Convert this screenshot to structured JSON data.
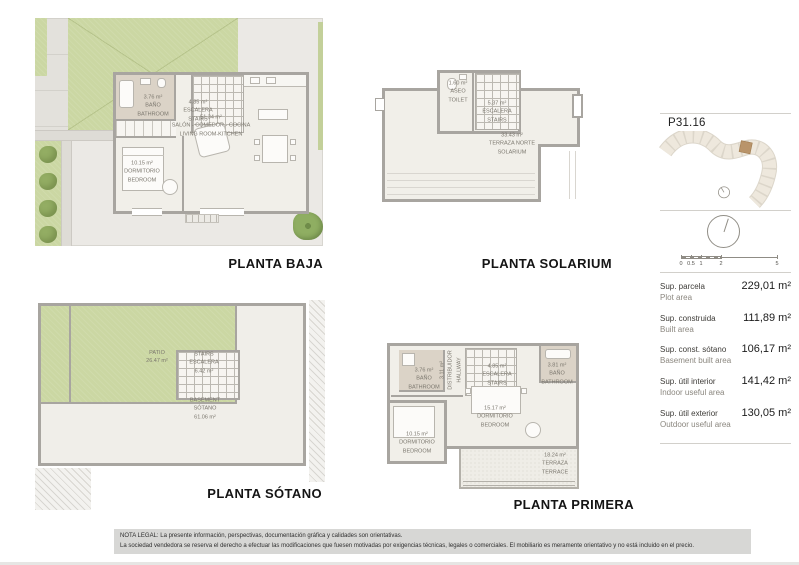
{
  "plans": [
    {
      "title": "PLANTA BAJA",
      "rooms": {
        "bathroom": [
          "3.76 m²",
          "BAÑO",
          "BATHROOM"
        ],
        "stairs": [
          "4.85 m²",
          "ESCALERA",
          "STAIRS"
        ],
        "living": [
          "51.34 m²",
          "SALÓN - COMEDOR - COCINA",
          "LIVING ROOM-KITCHEN"
        ],
        "bedroom": [
          "10.15 m²",
          "DORMITORIO",
          "BEDROOM"
        ]
      }
    },
    {
      "title": "PLANTA SOLARIUM",
      "rooms": {
        "toilet": [
          "1.60 m²",
          "ASEO",
          "TOILET"
        ],
        "stairs": [
          "5.37 m²",
          "ESCALERA",
          "STAIRS"
        ],
        "solarium": [
          "33.43 m²",
          "TERRAZA NORTE",
          "SOLARIUM"
        ]
      }
    },
    {
      "title": "PLANTA SÓTANO",
      "rooms": {
        "patio": [
          "PATIO",
          "26.47 m²"
        ],
        "stairs": [
          "STAIRS",
          "ESCALERA",
          "6.42 m²"
        ],
        "basement": [
          "BASEMENT",
          "SÓTANO",
          "61.06 m²"
        ]
      }
    },
    {
      "title": "PLANTA PRIMERA",
      "rooms": {
        "bathroom_left": [
          "3.76 m²",
          "BAÑO",
          "BATHROOM"
        ],
        "hallway": [
          "3.11 m²",
          "DISTRIBUIDOR",
          "HALLWAY"
        ],
        "stairs": [
          "4.85 m²",
          "ESCALERA",
          "STAIRS"
        ],
        "bathroom_right": [
          "3.81 m²",
          "BAÑO",
          "BATHROOM"
        ],
        "bedroom_main": [
          "15.17 m²",
          "DORMITORIO",
          "BEDROOM"
        ],
        "bedroom_left": [
          "10.15 m²",
          "DORMITORIO",
          "BEDROOM"
        ],
        "terrace": [
          "18.24 m²",
          "TERRAZA",
          "TERRACE"
        ]
      }
    }
  ],
  "sidebar": {
    "plot_ref": "P31.16",
    "scale_ticks": [
      "0",
      "0.5",
      "1",
      "2",
      "5"
    ],
    "areas": [
      {
        "es": "Sup. parcela",
        "en": "Plot area",
        "value": "229,01 m²"
      },
      {
        "es": "Sup. construida",
        "en": "Built area",
        "value": "111,89 m²"
      },
      {
        "es": "Sup. const. sótano",
        "en": "Basement built area",
        "value": "106,17 m²"
      },
      {
        "es": "Sup. útil interior",
        "en": "Indoor useful area",
        "value": "141,42 m²"
      },
      {
        "es": "Sup. útil exterior",
        "en": "Outdoor useful area",
        "value": "130,05 m²"
      }
    ]
  },
  "legal": {
    "line1": "NOTA LEGAL: La presente información, perspectivas, documentación gráfica y calidades son orientativas.",
    "line2": "La sociedad vendedora se reserva el derecho a efectuar las modificaciones que fuesen motivadas por exigencias técnicas, legales o comerciales. El mobiliario es meramente orientativo y no está incluido en el precio."
  },
  "colors": {
    "garden_green": "#cbd7a3",
    "wall_gray": "#a8a5a0",
    "room_fill": "#f1efe9",
    "bath_fill": "#dbd3c7",
    "highlight_plot": "#b9946a",
    "legal_bg": "#d7d7d5"
  }
}
